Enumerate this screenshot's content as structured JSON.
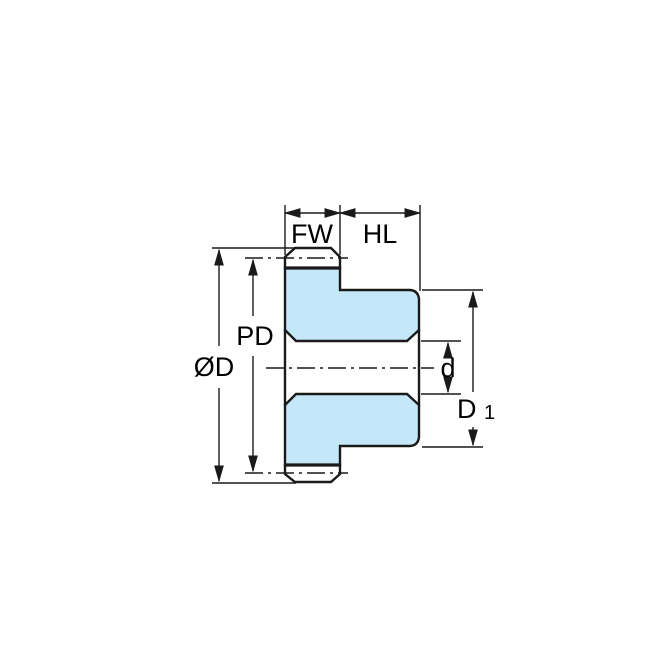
{
  "diagram": {
    "subject": "Spur gear cross-section dimension drawing",
    "colors": {
      "part_fill": "#C5E8F8",
      "line": "#1A1A1A",
      "background": "#FFFFFF"
    },
    "labels": {
      "face_width": "FW",
      "hub_length": "HL",
      "pitch_diameter": "PD",
      "outside_diameter": "ØD",
      "bore_diameter": "d",
      "hub_diameter_base": "D",
      "hub_diameter_subscript": "1"
    }
  }
}
